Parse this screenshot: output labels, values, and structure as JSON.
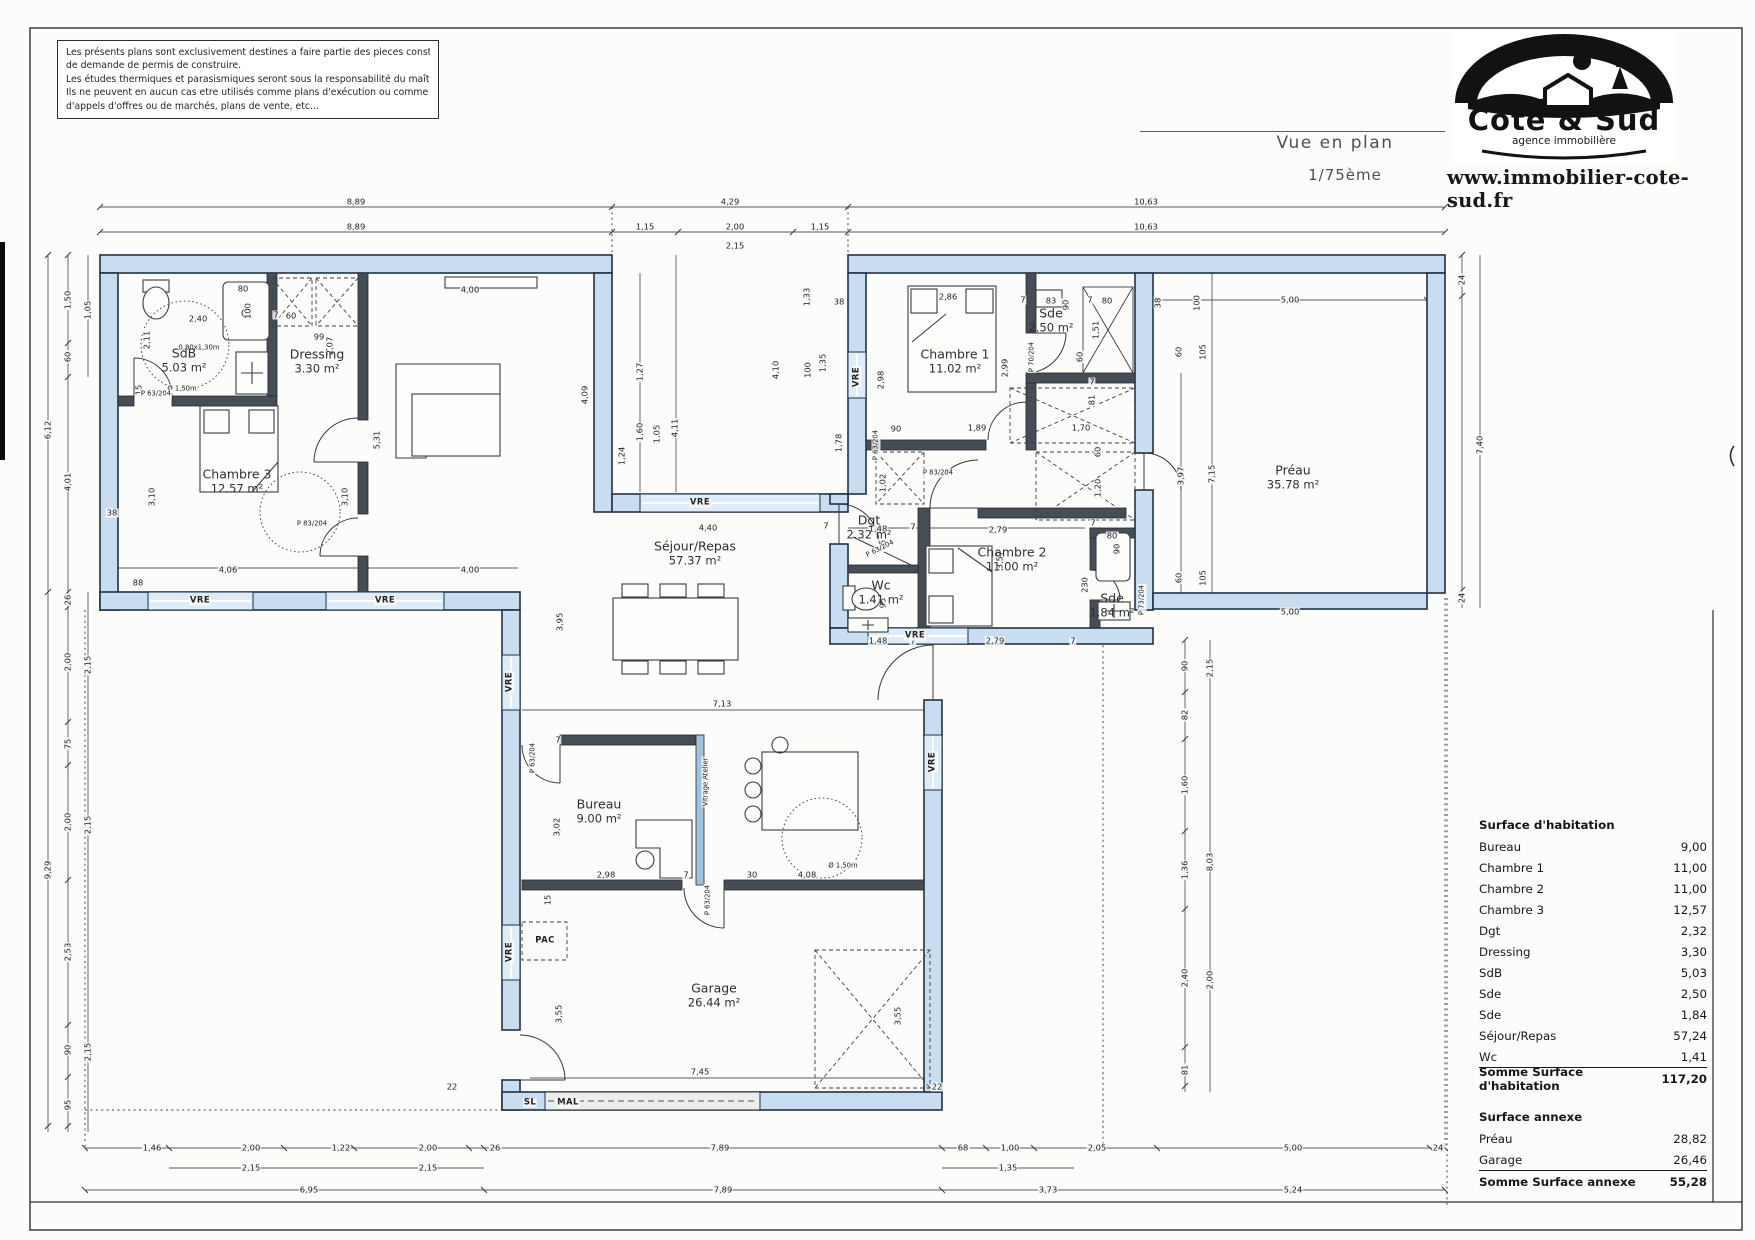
{
  "disclaimer": {
    "lines": [
      "Les présents plans sont exclusivement destines a faire partie des pieces constituant le dossier administratif",
      "de demande de permis de construire.",
      "Les études thermiques et parasismiques seront sous la responsabilité du maître d'ouvrage et/ou du constructeur.",
      "Ils ne peuvent en aucun cas etre utilisés comme plans d'exécution ou comme plans constituant les dossiers",
      "d'appels d'offres ou de marchés, plans de vente, etc..."
    ]
  },
  "titleblock": {
    "view_title": "Vue en plan",
    "scale": "1/75ème",
    "website": "www.immobilier-cote-sud.fr",
    "logo": {
      "name": "Côte & Sud",
      "tagline": "agence immobilière"
    }
  },
  "plan": {
    "colors": {
      "wall_fill": "#c8def0",
      "wall_stroke": "#203244",
      "window_fill": "#ddecf8",
      "line": "#555a60"
    },
    "rooms": [
      {
        "name": "SdB",
        "area": "5.03 m²",
        "x": 184,
        "y": 360
      },
      {
        "name": "Dressing",
        "area": "3.30 m²",
        "x": 317,
        "y": 361
      },
      {
        "name": "Chambre 3",
        "area": "12.57 m²",
        "x": 237,
        "y": 481
      },
      {
        "name": "Séjour/Repas",
        "area": "57.37 m²",
        "x": 695,
        "y": 553
      },
      {
        "name": "Chambre 1",
        "area": "11.02 m²",
        "x": 955,
        "y": 361
      },
      {
        "name": "Sde",
        "area": "2.50 m²",
        "x": 1051,
        "y": 320
      },
      {
        "name": "Chambre 2",
        "area": "11.00 m²",
        "x": 1012,
        "y": 559
      },
      {
        "name": "Dgt",
        "area": "2.32 m²",
        "x": 869,
        "y": 527
      },
      {
        "name": "Wc",
        "area": "1.41 m²",
        "x": 881,
        "y": 592
      },
      {
        "name": "Sde",
        "area": "1.84 m²",
        "x": 1112,
        "y": 605
      },
      {
        "name": "Préau",
        "area": "35.78 m²",
        "x": 1293,
        "y": 477
      },
      {
        "name": "Bureau",
        "area": "9.00 m²",
        "x": 599,
        "y": 811
      },
      {
        "name": "Garage",
        "area": "26.44 m²",
        "x": 714,
        "y": 995
      }
    ],
    "labels": [
      {
        "t": "8,89",
        "x": 356,
        "y": 202
      },
      {
        "t": "4,29",
        "x": 730,
        "y": 202
      },
      {
        "t": "10,63",
        "x": 1146,
        "y": 202
      },
      {
        "t": "8,89",
        "x": 356,
        "y": 227
      },
      {
        "t": "1,15",
        "x": 645,
        "y": 227
      },
      {
        "t": "2,00",
        "x": 735,
        "y": 227
      },
      {
        "t": "1,15",
        "x": 820,
        "y": 227
      },
      {
        "t": "10,63",
        "x": 1146,
        "y": 227
      },
      {
        "t": "2,15",
        "x": 735,
        "y": 246
      },
      {
        "t": "6,12",
        "x": 48,
        "y": 430,
        "r": -90
      },
      {
        "t": "9,29",
        "x": 48,
        "y": 870,
        "r": -90
      },
      {
        "t": "1,50",
        "x": 68,
        "y": 300,
        "r": -90
      },
      {
        "t": "60",
        "x": 68,
        "y": 357,
        "r": -90
      },
      {
        "t": "1,05",
        "x": 88,
        "y": 310,
        "r": -90
      },
      {
        "t": "4,01",
        "x": 68,
        "y": 482,
        "r": -90
      },
      {
        "t": "26",
        "x": 68,
        "y": 600,
        "r": -90
      },
      {
        "t": "2,00",
        "x": 68,
        "y": 662,
        "r": -90
      },
      {
        "t": "2,15",
        "x": 88,
        "y": 665,
        "r": -90
      },
      {
        "t": "75",
        "x": 68,
        "y": 744,
        "r": -90
      },
      {
        "t": "2,00",
        "x": 68,
        "y": 822,
        "r": -90
      },
      {
        "t": "2,15",
        "x": 88,
        "y": 825,
        "r": -90
      },
      {
        "t": "2,53",
        "x": 68,
        "y": 952,
        "r": -90
      },
      {
        "t": "90",
        "x": 68,
        "y": 1050,
        "r": -90
      },
      {
        "t": "2,15",
        "x": 88,
        "y": 1052,
        "r": -90
      },
      {
        "t": "95",
        "x": 68,
        "y": 1105,
        "r": -90
      },
      {
        "t": "38",
        "x": 112,
        "y": 513
      },
      {
        "t": "88",
        "x": 138,
        "y": 583
      },
      {
        "t": "24",
        "x": 1462,
        "y": 280,
        "r": -90
      },
      {
        "t": "7,40",
        "x": 1480,
        "y": 445,
        "r": -90
      },
      {
        "t": "24",
        "x": 1462,
        "y": 598,
        "r": -90
      },
      {
        "t": "90",
        "x": 1185,
        "y": 666,
        "r": -90
      },
      {
        "t": "2,15",
        "x": 1210,
        "y": 668,
        "r": -90
      },
      {
        "t": "82",
        "x": 1185,
        "y": 715,
        "r": -90
      },
      {
        "t": "1,60",
        "x": 1185,
        "y": 785,
        "r": -90
      },
      {
        "t": "8,03",
        "x": 1210,
        "y": 862,
        "r": -90
      },
      {
        "t": "1,36",
        "x": 1185,
        "y": 870,
        "r": -90
      },
      {
        "t": "2,40",
        "x": 1185,
        "y": 978,
        "r": -90
      },
      {
        "t": "2,00",
        "x": 1210,
        "y": 980,
        "r": -90
      },
      {
        "t": "81",
        "x": 1185,
        "y": 1070,
        "r": -90
      },
      {
        "t": "1,46",
        "x": 152,
        "y": 1148
      },
      {
        "t": "2,00",
        "x": 251,
        "y": 1148
      },
      {
        "t": "1,22",
        "x": 341,
        "y": 1148
      },
      {
        "t": "2,00",
        "x": 428,
        "y": 1148
      },
      {
        "t": "26",
        "x": 495,
        "y": 1148
      },
      {
        "t": "7,89",
        "x": 720,
        "y": 1148
      },
      {
        "t": "68",
        "x": 963,
        "y": 1148
      },
      {
        "t": "1,00",
        "x": 1010,
        "y": 1148
      },
      {
        "t": "2,05",
        "x": 1097,
        "y": 1148
      },
      {
        "t": "5,00",
        "x": 1293,
        "y": 1148
      },
      {
        "t": "24",
        "x": 1438,
        "y": 1148
      },
      {
        "t": "2,15",
        "x": 251,
        "y": 1168
      },
      {
        "t": "2,15",
        "x": 428,
        "y": 1168
      },
      {
        "t": "1,35",
        "x": 1008,
        "y": 1168
      },
      {
        "t": "6,95",
        "x": 309,
        "y": 1190
      },
      {
        "t": "7,89",
        "x": 723,
        "y": 1190
      },
      {
        "t": "3,73",
        "x": 1048,
        "y": 1190
      },
      {
        "t": "5,24",
        "x": 1293,
        "y": 1190
      },
      {
        "t": "38",
        "x": 1158,
        "y": 303,
        "r": -90
      },
      {
        "t": "100",
        "x": 1197,
        "y": 303,
        "r": -90
      },
      {
        "t": "5,00",
        "x": 1290,
        "y": 300
      },
      {
        "t": "60",
        "x": 1179,
        "y": 352,
        "r": -90
      },
      {
        "t": "105",
        "x": 1203,
        "y": 352,
        "r": -90
      },
      {
        "t": "3,97",
        "x": 1181,
        "y": 476,
        "r": -90
      },
      {
        "t": "7,15",
        "x": 1212,
        "y": 474,
        "r": -90
      },
      {
        "t": "60",
        "x": 1179,
        "y": 578,
        "r": -90
      },
      {
        "t": "105",
        "x": 1203,
        "y": 578,
        "r": -90
      },
      {
        "t": "5,00",
        "x": 1290,
        "y": 612
      },
      {
        "t": "2,40",
        "x": 198,
        "y": 319
      },
      {
        "t": "80",
        "x": 243,
        "y": 289
      },
      {
        "t": "100",
        "x": 248,
        "y": 311,
        "r": -90
      },
      {
        "t": "7",
        "x": 276,
        "y": 315
      },
      {
        "t": "60",
        "x": 291,
        "y": 316
      },
      {
        "t": "99",
        "x": 319,
        "y": 337
      },
      {
        "t": "2,07",
        "x": 330,
        "y": 346,
        "r": -90
      },
      {
        "t": "2,11",
        "x": 147,
        "y": 340,
        "r": -90
      },
      {
        "t": "0,80x1,30m",
        "x": 199,
        "y": 348,
        "c": "s"
      },
      {
        "t": "Ø 1,50m",
        "x": 182,
        "y": 389,
        "c": "s"
      },
      {
        "t": "15",
        "x": 139,
        "y": 390,
        "r": -90
      },
      {
        "t": "P 63/204",
        "x": 156,
        "y": 394,
        "c": "s"
      },
      {
        "t": "3,10",
        "x": 152,
        "y": 497,
        "r": -90
      },
      {
        "t": "3,10",
        "x": 345,
        "y": 497,
        "r": -90
      },
      {
        "t": "5,31",
        "x": 377,
        "y": 440,
        "r": -90
      },
      {
        "t": "4,06",
        "x": 228,
        "y": 570
      },
      {
        "t": "4,00",
        "x": 470,
        "y": 570
      },
      {
        "t": "4,00",
        "x": 470,
        "y": 290
      },
      {
        "t": "P 83/204",
        "x": 312,
        "y": 524,
        "c": "s"
      },
      {
        "t": "4,09",
        "x": 585,
        "y": 395,
        "r": -90
      },
      {
        "t": "1,27",
        "x": 640,
        "y": 372,
        "r": -90
      },
      {
        "t": "1,60",
        "x": 640,
        "y": 432,
        "r": -90
      },
      {
        "t": "1,05",
        "x": 657,
        "y": 434,
        "r": -90
      },
      {
        "t": "4,11",
        "x": 675,
        "y": 428,
        "r": -90
      },
      {
        "t": "1,24",
        "x": 622,
        "y": 456,
        "r": -90
      },
      {
        "t": "4,40",
        "x": 708,
        "y": 528
      },
      {
        "t": "7",
        "x": 826,
        "y": 526
      },
      {
        "t": "3,95",
        "x": 560,
        "y": 622,
        "r": -90
      },
      {
        "t": "7,13",
        "x": 722,
        "y": 704
      },
      {
        "t": "Ø 1,50m",
        "x": 843,
        "y": 866,
        "c": "s"
      },
      {
        "t": "30",
        "x": 752,
        "y": 875
      },
      {
        "t": "4,08",
        "x": 807,
        "y": 875
      },
      {
        "t": "38",
        "x": 839,
        "y": 302
      },
      {
        "t": "1,33",
        "x": 807,
        "y": 297,
        "r": -90
      },
      {
        "t": "100",
        "x": 808,
        "y": 370,
        "r": -90
      },
      {
        "t": "1,35",
        "x": 823,
        "y": 363,
        "r": -90
      },
      {
        "t": "4,10",
        "x": 776,
        "y": 370,
        "r": -90
      },
      {
        "t": "1,78",
        "x": 839,
        "y": 443,
        "r": -90
      },
      {
        "t": "2,98",
        "x": 881,
        "y": 380,
        "r": -90
      },
      {
        "t": "2,86",
        "x": 948,
        "y": 297
      },
      {
        "t": "2,99",
        "x": 1005,
        "y": 368,
        "r": -90
      },
      {
        "t": "1,89",
        "x": 977,
        "y": 428
      },
      {
        "t": "90",
        "x": 896,
        "y": 429
      },
      {
        "t": "7",
        "x": 1023,
        "y": 300
      },
      {
        "t": "P 63/204",
        "x": 876,
        "y": 445,
        "r": -90,
        "c": "s"
      },
      {
        "t": "83",
        "x": 1051,
        "y": 301
      },
      {
        "t": "90",
        "x": 1066,
        "y": 305,
        "r": -90
      },
      {
        "t": "7",
        "x": 1090,
        "y": 300
      },
      {
        "t": "80",
        "x": 1107,
        "y": 301
      },
      {
        "t": "1,51",
        "x": 1096,
        "y": 330,
        "r": -90
      },
      {
        "t": "60",
        "x": 1080,
        "y": 357,
        "r": -90
      },
      {
        "t": "P 70/204",
        "x": 1032,
        "y": 357,
        "r": -90,
        "c": "s"
      },
      {
        "t": "1,70",
        "x": 1081,
        "y": 428
      },
      {
        "t": "81",
        "x": 1092,
        "y": 400,
        "r": -90
      },
      {
        "t": "7",
        "x": 1092,
        "y": 382
      },
      {
        "t": "60",
        "x": 1098,
        "y": 452,
        "r": -90
      },
      {
        "t": "1,20",
        "x": 1098,
        "y": 488,
        "r": -90
      },
      {
        "t": "7",
        "x": 1093,
        "y": 523
      },
      {
        "t": "1,02",
        "x": 883,
        "y": 483,
        "r": -90
      },
      {
        "t": "1,48",
        "x": 878,
        "y": 529
      },
      {
        "t": "7",
        "x": 913,
        "y": 527
      },
      {
        "t": "2,79",
        "x": 998,
        "y": 530
      },
      {
        "t": "95",
        "x": 883,
        "y": 545,
        "r": -90
      },
      {
        "t": "95",
        "x": 883,
        "y": 603,
        "r": -90
      },
      {
        "t": "3,57",
        "x": 1000,
        "y": 560,
        "r": -90
      },
      {
        "t": "P 83/204",
        "x": 938,
        "y": 473,
        "c": "s"
      },
      {
        "t": "P 63/204",
        "x": 880,
        "y": 549,
        "r": -27,
        "c": "s"
      },
      {
        "t": "1,48",
        "x": 878,
        "y": 641
      },
      {
        "t": "7",
        "x": 913,
        "y": 641
      },
      {
        "t": "2,79",
        "x": 995,
        "y": 641
      },
      {
        "t": "7",
        "x": 1073,
        "y": 641
      },
      {
        "t": "230",
        "x": 1085,
        "y": 585,
        "r": -90
      },
      {
        "t": "P 73/204",
        "x": 1142,
        "y": 600,
        "r": -90,
        "c": "s"
      },
      {
        "t": "80",
        "x": 1112,
        "y": 536
      },
      {
        "t": "90",
        "x": 1117,
        "y": 549,
        "r": -90
      },
      {
        "t": "3,02",
        "x": 557,
        "y": 827,
        "r": -90
      },
      {
        "t": "2,98",
        "x": 606,
        "y": 875
      },
      {
        "t": "7",
        "x": 686,
        "y": 875
      },
      {
        "t": "15",
        "x": 548,
        "y": 900,
        "r": -90
      },
      {
        "t": "P 63/204",
        "x": 533,
        "y": 758,
        "r": -90,
        "c": "s"
      },
      {
        "t": "7",
        "x": 558,
        "y": 740
      },
      {
        "t": "P 63/204",
        "x": 708,
        "y": 900,
        "r": -90,
        "c": "s"
      },
      {
        "t": "3,55",
        "x": 559,
        "y": 1014,
        "r": -90
      },
      {
        "t": "3,55",
        "x": 898,
        "y": 1016,
        "r": -90
      },
      {
        "t": "22",
        "x": 452,
        "y": 1087
      },
      {
        "t": "22",
        "x": 937,
        "y": 1087
      },
      {
        "t": "7,45",
        "x": 700,
        "y": 1072
      },
      {
        "t": "VRE",
        "x": 200,
        "y": 601,
        "c": "a"
      },
      {
        "t": "VRE",
        "x": 385,
        "y": 601,
        "c": "a"
      },
      {
        "t": "VRE",
        "x": 700,
        "y": 503,
        "c": "a"
      },
      {
        "t": "VRE",
        "x": 857,
        "y": 377,
        "r": -90,
        "c": "a"
      },
      {
        "t": "VRE",
        "x": 915,
        "y": 636,
        "c": "a"
      },
      {
        "t": "VRE",
        "x": 510,
        "y": 682,
        "r": -90,
        "c": "a"
      },
      {
        "t": "VRE",
        "x": 510,
        "y": 952,
        "r": -90,
        "c": "a"
      },
      {
        "t": "VRE",
        "x": 933,
        "y": 762,
        "r": -90,
        "c": "a"
      },
      {
        "t": "PAC",
        "x": 545,
        "y": 941,
        "c": "a"
      },
      {
        "t": "SL",
        "x": 530,
        "y": 1103,
        "c": "a"
      },
      {
        "t": "MAL",
        "x": 568,
        "y": 1103,
        "c": "a"
      },
      {
        "t": "Vitrage Atelier",
        "x": 706,
        "y": 782,
        "r": -90,
        "c": "s"
      }
    ]
  },
  "surface_table": {
    "habitation_title": "Surface d'habitation",
    "habitation_rows": [
      [
        "Bureau",
        "9,00"
      ],
      [
        "Chambre 1",
        "11,00"
      ],
      [
        "Chambre 2",
        "11,00"
      ],
      [
        "Chambre 3",
        "12,57"
      ],
      [
        "Dgt",
        "2,32"
      ],
      [
        "Dressing",
        "3,30"
      ],
      [
        "SdB",
        "5,03"
      ],
      [
        "Sde",
        "2,50"
      ],
      [
        "Sde",
        "1,84"
      ],
      [
        "Séjour/Repas",
        "57,24"
      ],
      [
        "Wc",
        "1,41"
      ]
    ],
    "habitation_total_label": "Somme Surface d'habitation",
    "habitation_total": "117,20",
    "annexe_title": "Surface annexe",
    "annexe_rows": [
      [
        "Préau",
        "28,82"
      ],
      [
        "Garage",
        "26,46"
      ]
    ],
    "annexe_total_label": "Somme Surface annexe",
    "annexe_total": "55,28"
  }
}
